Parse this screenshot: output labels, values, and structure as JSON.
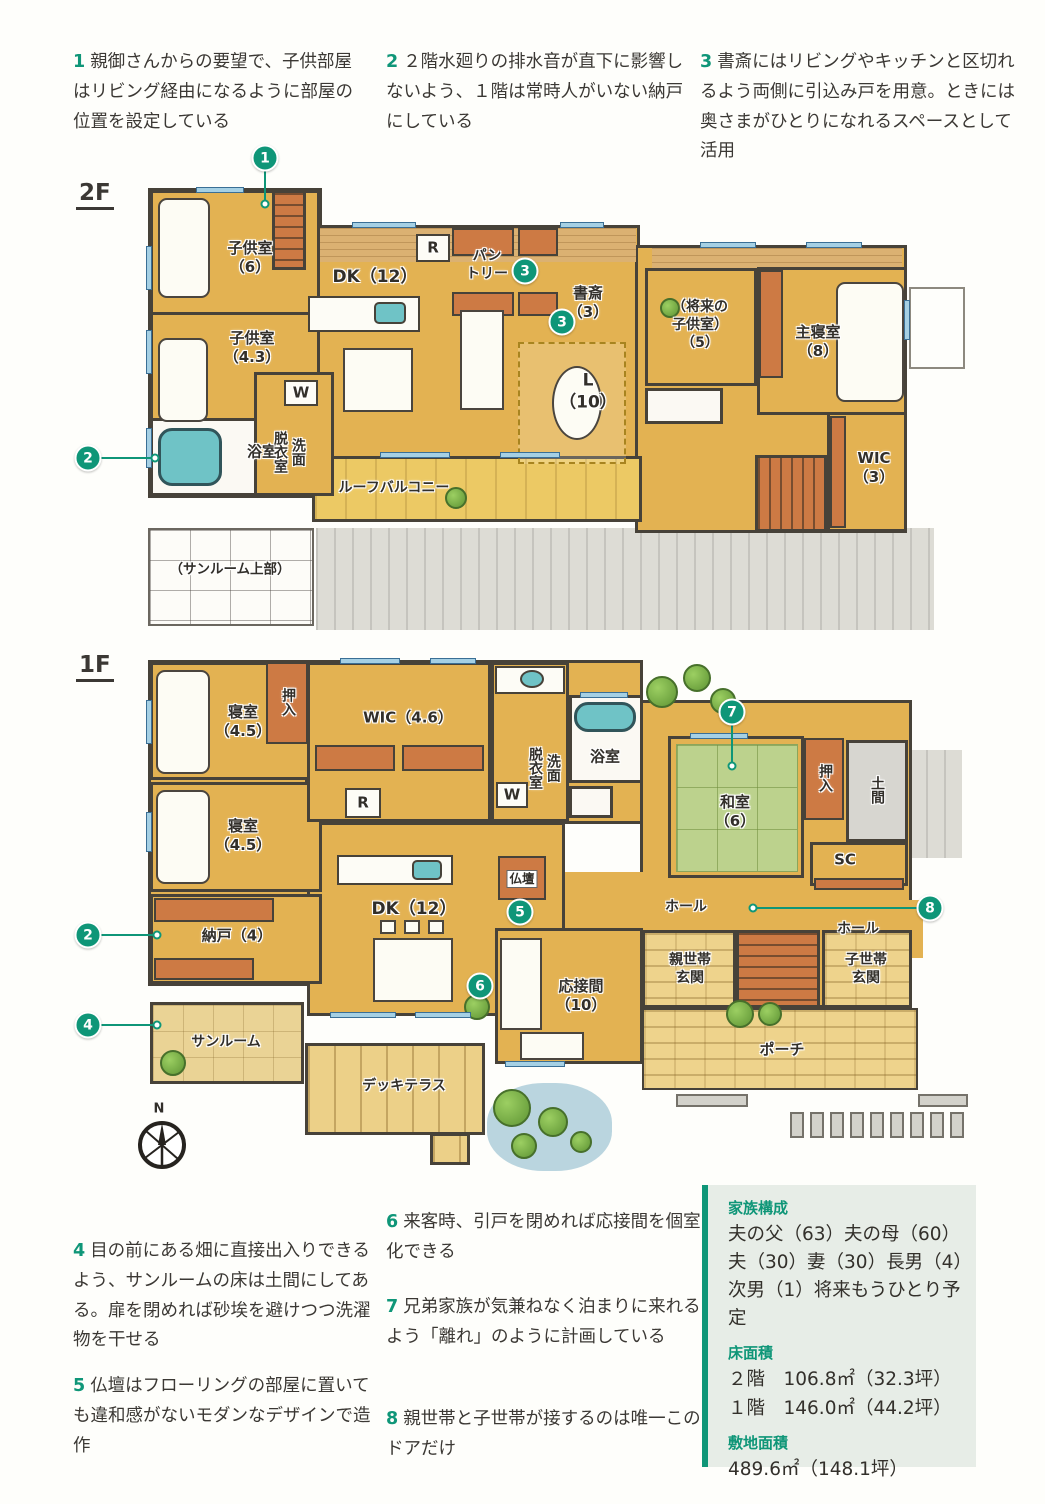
{
  "colors": {
    "accent": "#0f9678",
    "floor": "#e3b252",
    "wall": "#474239",
    "tatami": "#bcd28d",
    "closet": "#cd7a44",
    "tub": "#6fc3c6",
    "infobox_bg": "#e7ede7"
  },
  "annotations_top": [
    {
      "num": "1",
      "text": "親御さんからの要望で、子供部屋はリビング経由になるように部屋の位置を設定している"
    },
    {
      "num": "2",
      "text": "２階水廻りの排水音が直下に影響しないよう、１階は常時人がいない納戸にしている"
    },
    {
      "num": "3",
      "text": "書斎にはリビングやキッチンと区切れるよう両側に引込み戸を用意。ときには奥さまがひとりになれるスペースとして活用"
    }
  ],
  "annotations_bottom": [
    {
      "num": "4",
      "text": "目の前にある畑に直接出入りできるよう、サンルームの床は土間にしてある。扉を閉めれば砂埃を避けつつ洗濯物を干せる"
    },
    {
      "num": "5",
      "text": "仏壇はフローリングの部屋に置いても違和感がないモダンなデザインで造作"
    },
    {
      "num": "6",
      "text": "来客時、引戸を閉めれば応接間を個室化できる"
    },
    {
      "num": "7",
      "text": "兄弟家族が気兼ねなく泊まりに来れるよう「離れ」のように計画している"
    },
    {
      "num": "8",
      "text": "親世帯と子世帯が接するのは唯一このドアだけ"
    }
  ],
  "markers": {
    "m1": "1",
    "m2": "2",
    "m3": "3",
    "m4": "4",
    "m5": "5",
    "m6": "6",
    "m7": "7",
    "m8": "8"
  },
  "floor2": {
    "label": "2F",
    "rooms": {
      "kids6": "子供室\n（6）",
      "kids43": "子供室\n（4.3）",
      "bath": "浴室",
      "laundry": "洗面\n脱衣室",
      "w": "W",
      "r": "R",
      "dk": "DK（12）",
      "pantry": "パン\nトリー",
      "study": "書斎\n（3）",
      "living": "L\n（10）",
      "future_kids": "（将来の\n子供室）\n（5）",
      "master": "主寝室\n（8）",
      "wic": "WIC\n（3）",
      "balcony": "ルーフバルコニー",
      "sunroom_upper": "（サンルーム上部）"
    }
  },
  "floor1": {
    "label": "1F",
    "compass_n": "N",
    "rooms": {
      "bed1": "寝室\n（4.5）",
      "oshiire1": "押入",
      "bed2": "寝室\n（4.5）",
      "nando": "納戸（4）",
      "wic": "WIC（4.6）",
      "r": "R",
      "w": "W",
      "laundry": "洗面\n脱衣室",
      "bath": "浴室",
      "dk": "DK（12）",
      "butsudan": "仏壇",
      "drawing_room": "応接間\n（10）",
      "washitsu": "和室\n（6）",
      "oshiire2": "押入",
      "doma": "土間",
      "sc": "SC",
      "hall1": "ホール",
      "hall2": "ホール",
      "parents_entrance": "親世帯\n玄関",
      "children_entrance": "子世帯\n玄関",
      "porch": "ポーチ",
      "sunroom": "サンルーム",
      "deck": "デッキテラス"
    }
  },
  "info_box": {
    "sections": [
      {
        "heading": "家族構成",
        "lines": [
          "夫の父（63）夫の母（60）",
          "夫（30）妻（30）長男（4）",
          "次男（1）将来もうひとり予定"
        ]
      },
      {
        "heading": "床面積",
        "lines": [
          "２階　106.8㎡（32.3坪）",
          "１階　146.0㎡（44.2坪）",
          ""
        ]
      },
      {
        "heading": "敷地面積",
        "lines": [
          "489.6㎡（148.1坪）",
          "",
          ""
        ]
      }
    ]
  }
}
